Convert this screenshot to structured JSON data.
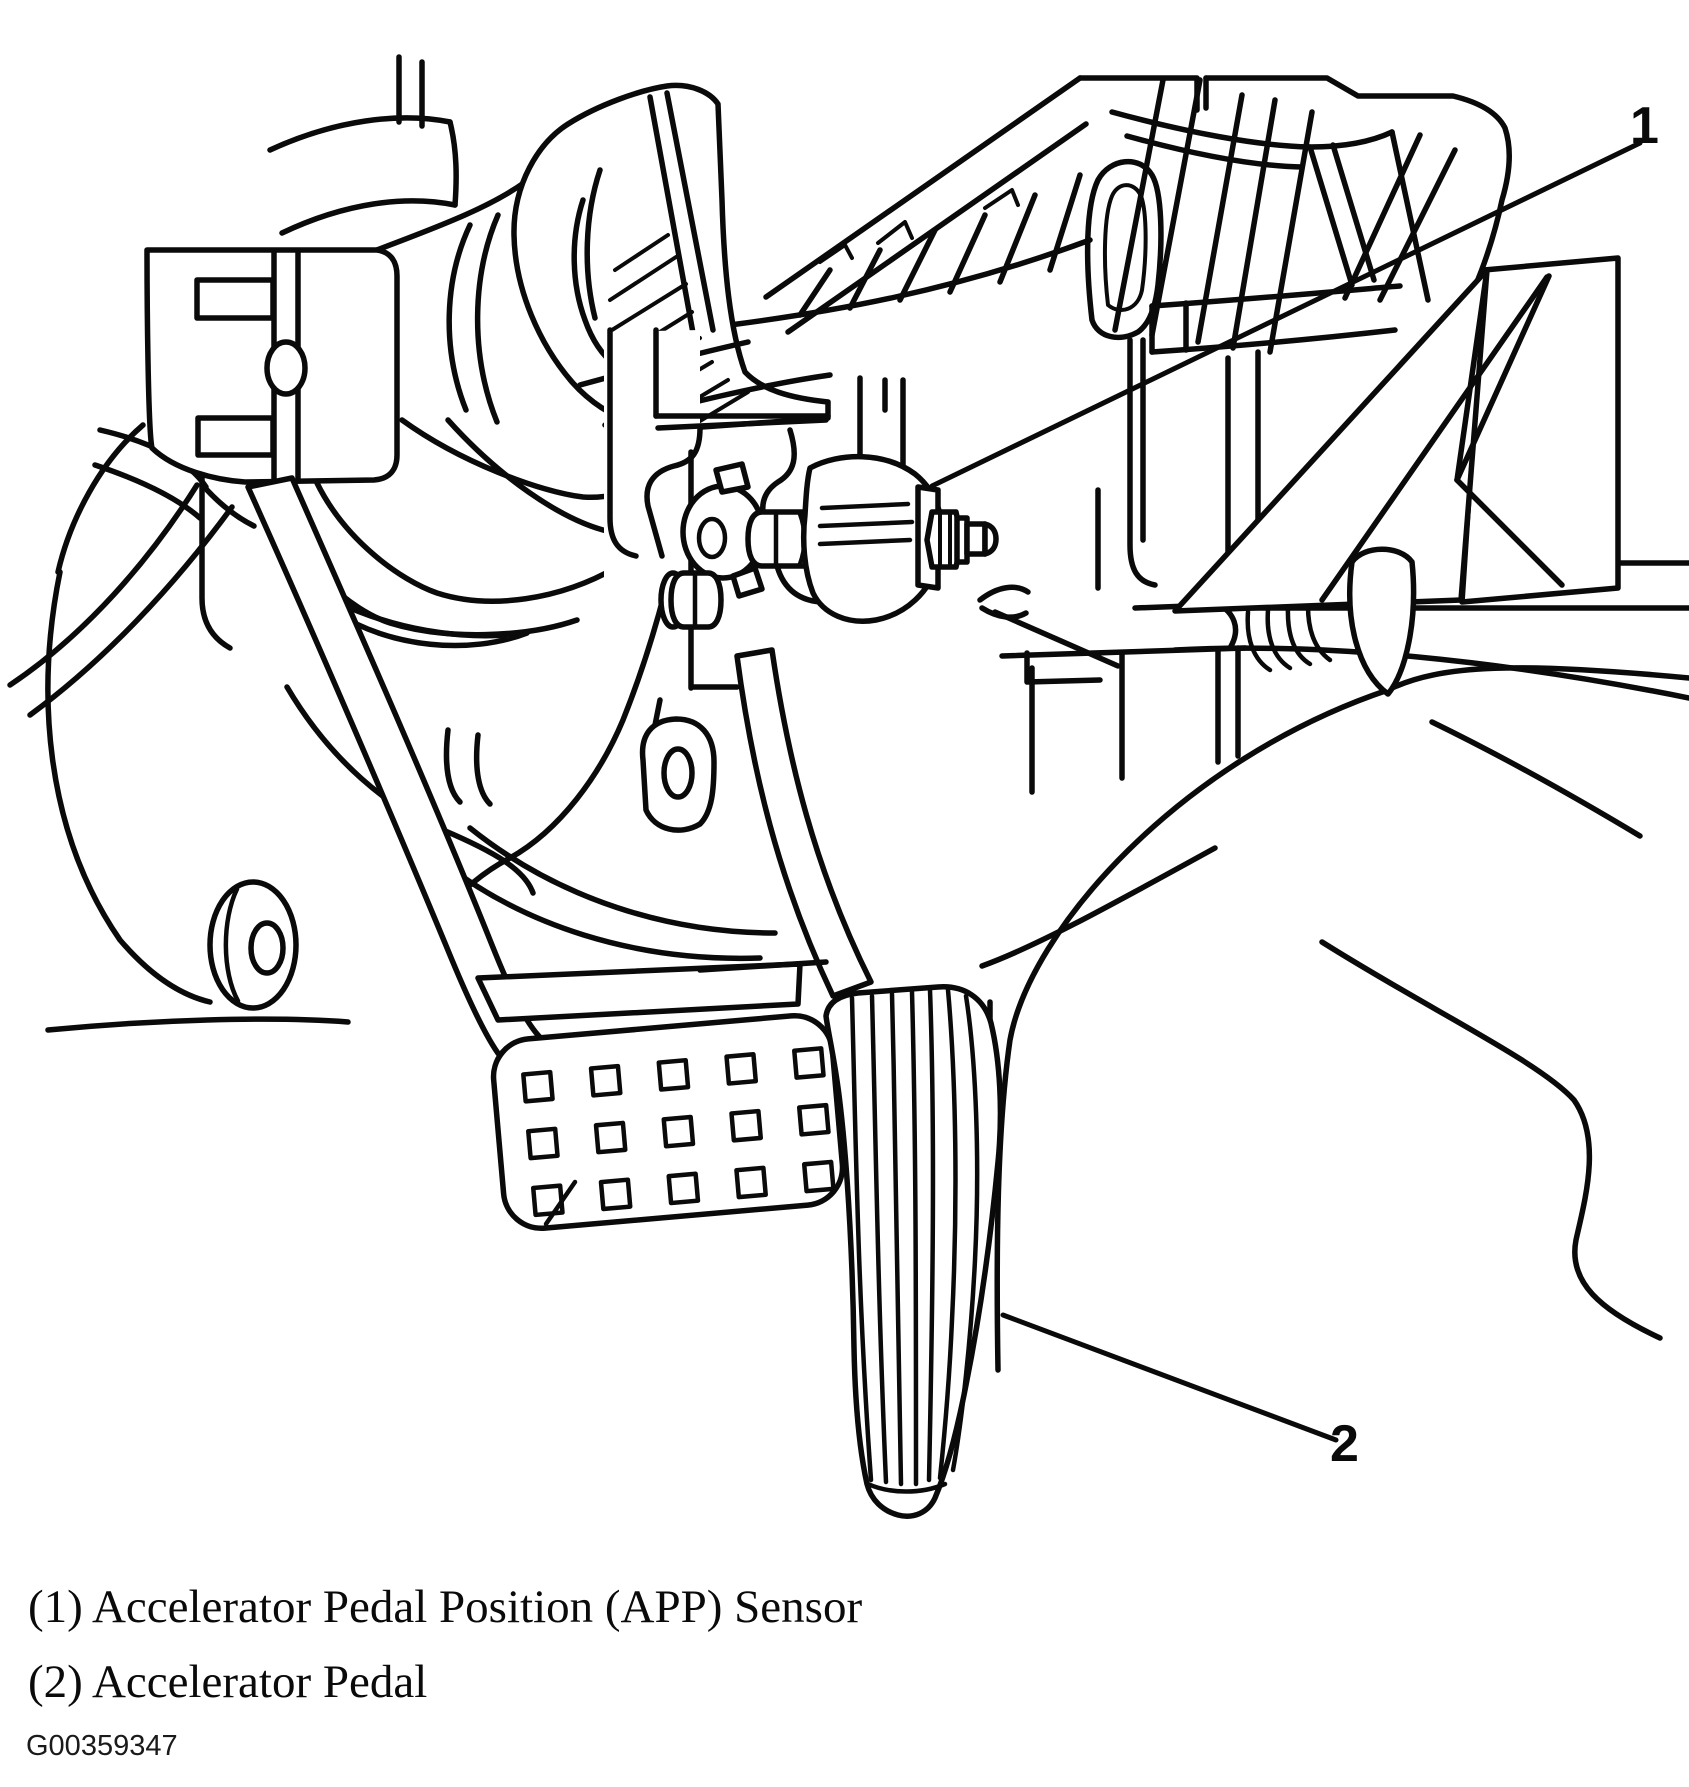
{
  "figure": {
    "background": "#ffffff",
    "line_color": "#0a0a0a",
    "callouts": {
      "one": "1",
      "two": "2"
    },
    "caption_line_1": "(1) Accelerator Pedal Position (APP) Sensor",
    "caption_line_2": "(2) Accelerator Pedal",
    "figure_id": "G00359347"
  }
}
